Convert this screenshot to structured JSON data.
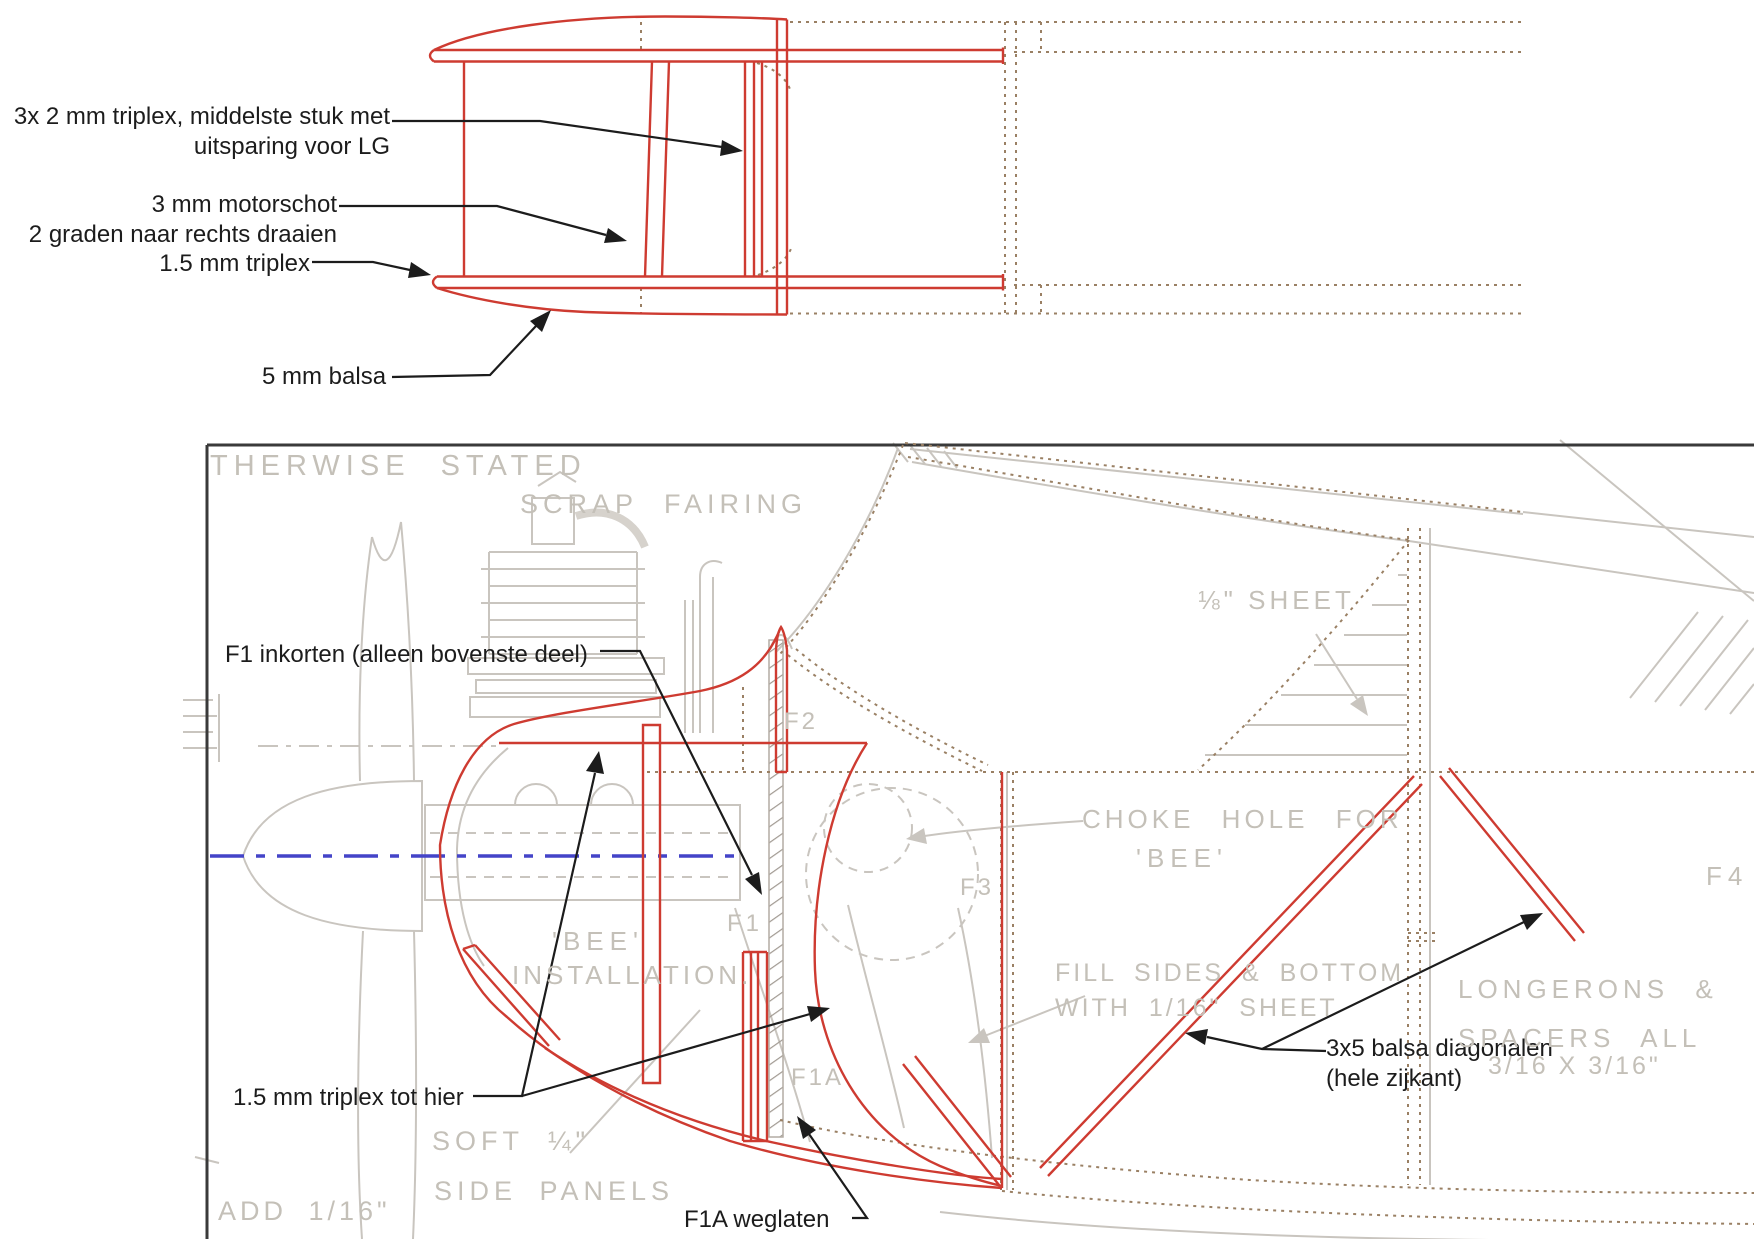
{
  "document": {
    "type": "model-aircraft construction plan (nose section, side + top view)",
    "language_overlay": "Dutch",
    "language_underlay": "English"
  },
  "colors": {
    "red_overlay": "#ce3b31",
    "grey_underlay": "#c9c5bf",
    "grey_text": "#c4c0b8",
    "brown_dotted": "#9a8064",
    "blue_centerline": "#4444c8",
    "black_annotation": "#1c1c1c",
    "frame_border": "#3a3a3a"
  },
  "top_view": {
    "annotations": {
      "triplex3x2_line1": "3x 2 mm triplex, middelste stuk met",
      "triplex3x2_line2": "uitsparing voor LG",
      "motorschot_line1": "3 mm motorschot",
      "motorschot_line2": "2 graden naar rechts draaien",
      "triplex15": "1.5 mm triplex",
      "balsa5": "5 mm balsa"
    }
  },
  "side_view": {
    "annotations": {
      "f1_inkorten": "F1 inkorten (alleen bovenste deel)",
      "triplex15_tot_hier": "1.5 mm triplex tot hier",
      "f1a_weglaten": "F1A weglaten",
      "diagonalen_line1": "3x5 balsa diagonalen",
      "diagonalen_line2": "(hele zijkant)"
    },
    "plan_texts": {
      "otherwise_stated": "THERWISE STATED",
      "scrap_fairing": "SCRAP FAIRING",
      "sheet_18": "⅛\" SHEET",
      "choke_hole_for": "CHOKE HOLE FOR",
      "bee_right": "'BEE'",
      "bee_left": "'BEE'",
      "installation": "INSTALLATION.",
      "fill_sides": "FILL SIDES & BOTTOM",
      "with_sheet": "WITH 1/16\" SHEET",
      "longerons": "LONGERONS &",
      "spacers": "SPACERS ALL",
      "spacers_size": "3/16 X 3/16\"",
      "soft_quarter": "SOFT ¼\"",
      "side_panels": "SIDE PANELS",
      "add_116": "ADD 1/16\""
    },
    "former_labels": {
      "f1": "F1",
      "f1a": "F1A",
      "f2": "F2",
      "f3": "F3",
      "f4": "F4"
    }
  }
}
